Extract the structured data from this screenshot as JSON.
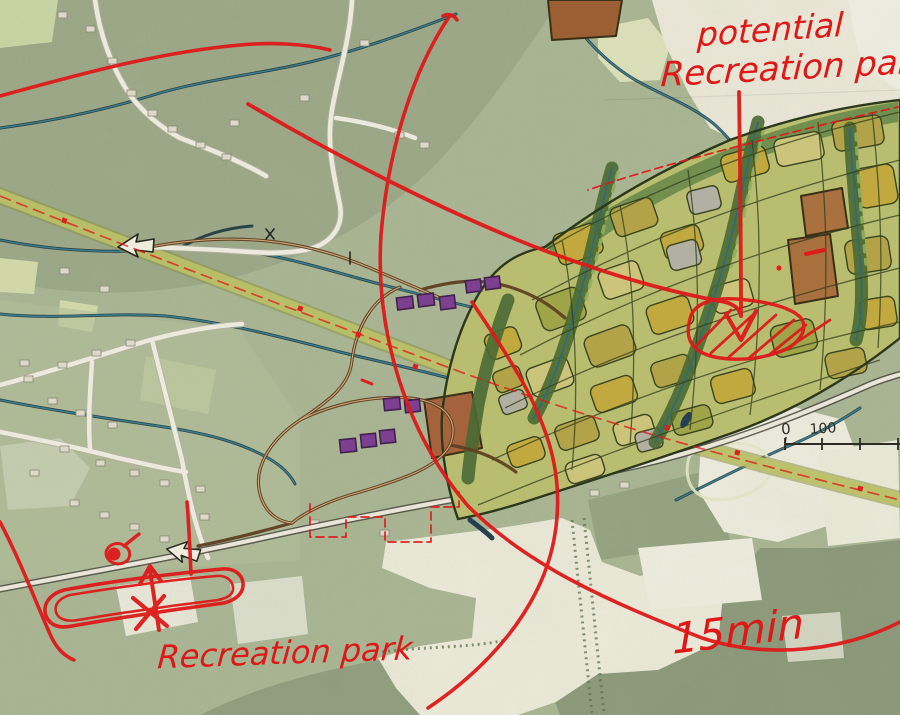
{
  "map": {
    "type": "hand-annotated aerial master-plan sketch",
    "annotations": {
      "top_label_line1": "potential",
      "top_label_line2": "Recreation park",
      "bottom_label": "Recreation park",
      "radius_label": "15min"
    },
    "scale_bar": {
      "start": "0",
      "end": "100"
    },
    "markers": [
      "west-arrow-icon",
      "southwest-arrow-icon",
      "down-arrowhead-icon",
      "up-arrow-icon",
      "x-mark",
      "hatched-site-outline",
      "site-loop-outline",
      "walk-radius-arcs"
    ],
    "colors": {
      "marker_red": "#de1717",
      "map_sage": "#a9b593",
      "forest_dark": "#8e9c7c",
      "field_cream": "#efecdb",
      "greenway_olive": "#b6bc66",
      "stream_teal": "#2f6a7c",
      "parcel_mustard": "#c2a93f",
      "parcel_sienna": "#a8713f",
      "building_purple": "#7d3f8f",
      "trail_brown": "#5f4023",
      "ink_black": "#2c2c24"
    }
  }
}
